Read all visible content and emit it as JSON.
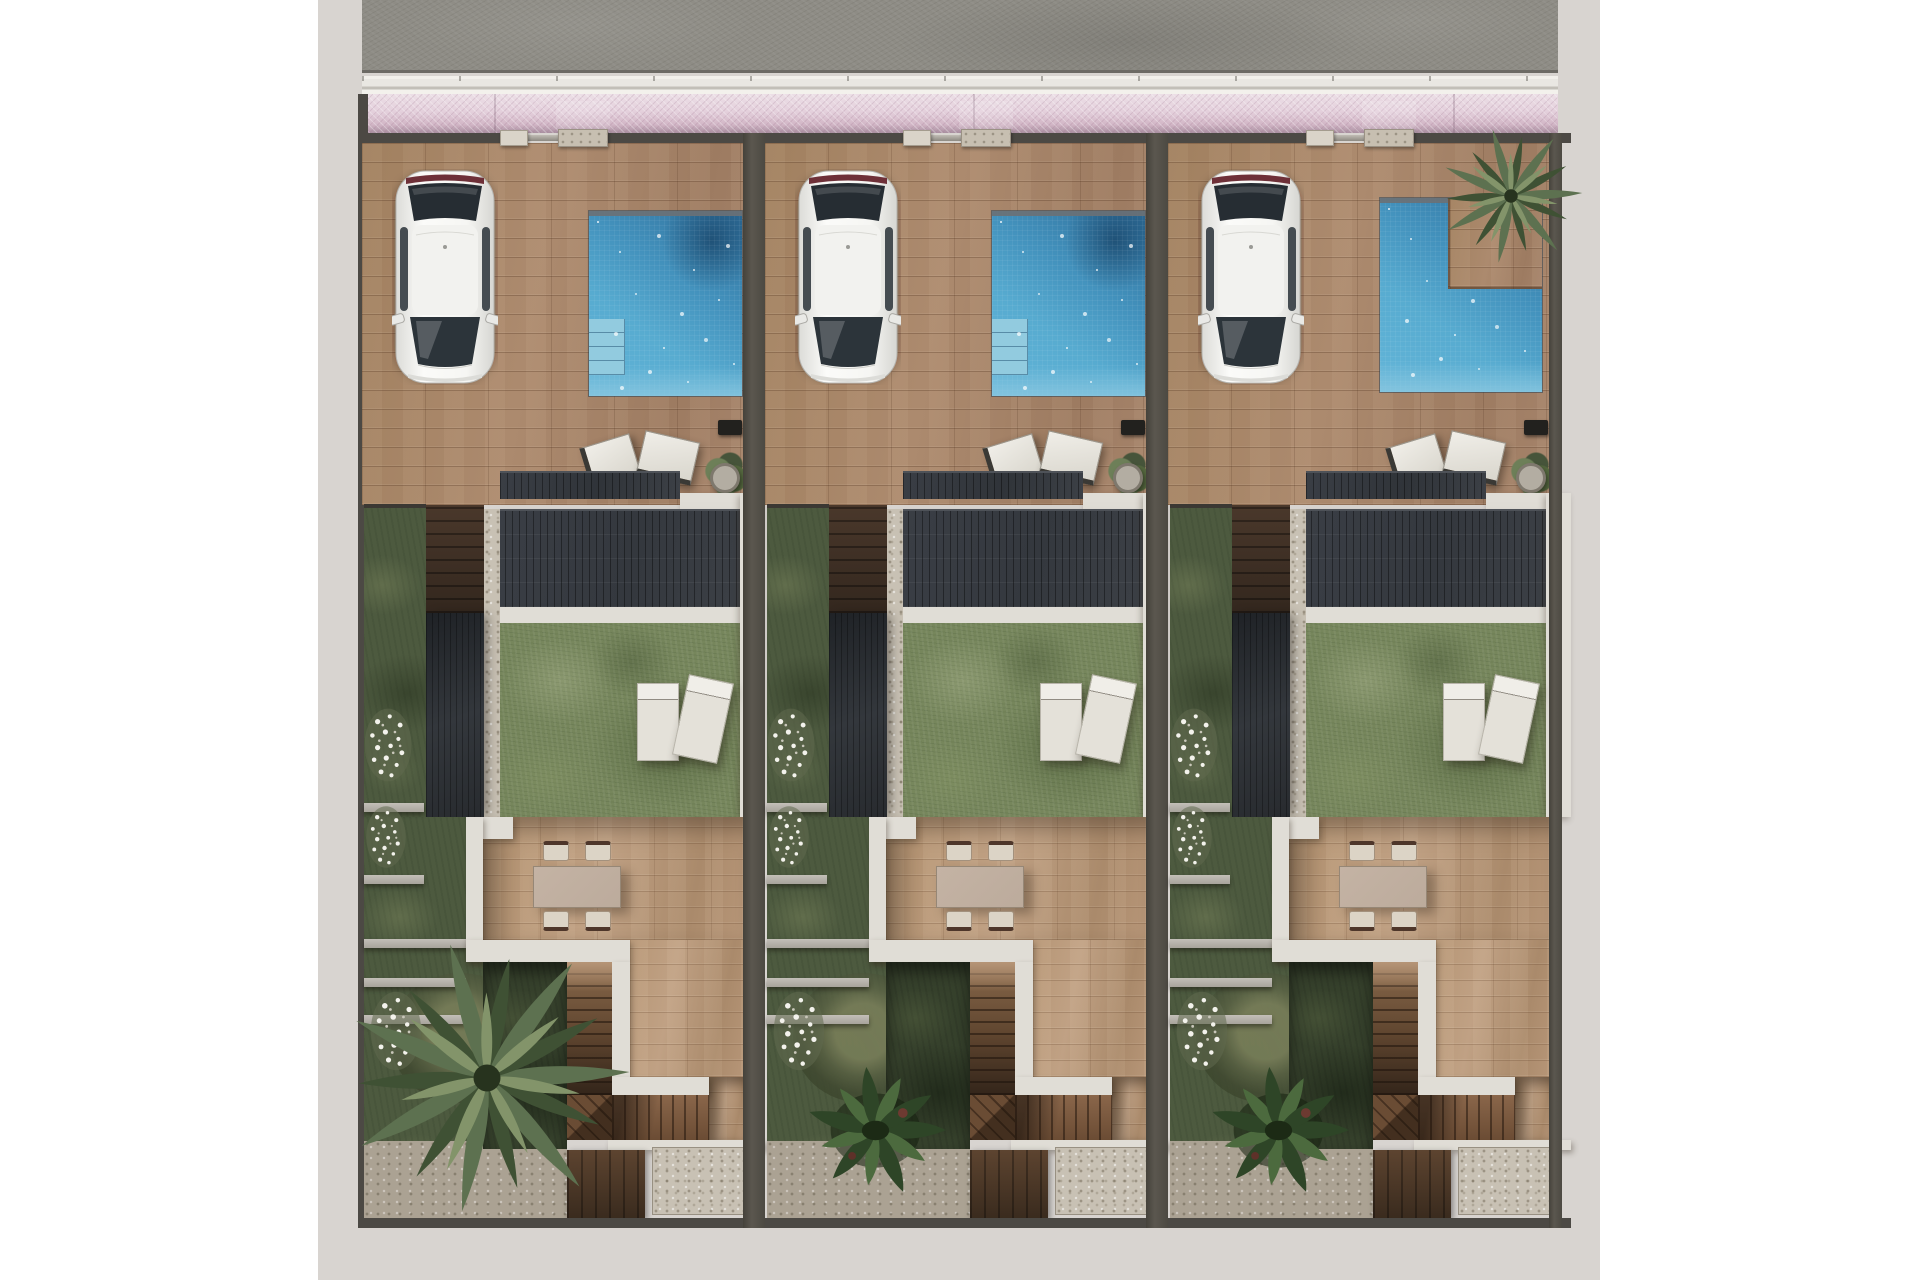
{
  "scene": {
    "label": "Aerial 3D site-plan render of three identical attached villas, each with street gate, paved driveway with parked white car, private pool, solar-panel roof, rear lawn with sun loungers, patio dining set, side stair garden and rear stairs down to a lower garden",
    "units_count": 3,
    "orientation": "street at top, rear gardens at bottom"
  },
  "palette": {
    "margin": "#ffffff",
    "apron": "#d8d4d0",
    "asphalt": "#8e8c85",
    "curb": "#e9e7e2",
    "sidewalk-hi": "#ecdfe6",
    "sidewalk-lo": "#a98fa0",
    "wall-dark": "#4c4944",
    "pier-light": "#dad4c9",
    "pier-mid": "#c7bfb1",
    "drive-base": "#a5836a",
    "patio-base": "#b69577",
    "pool-main": "#57abd0",
    "pool-deep": "#2e6d99",
    "pool-shallow": "#8cc8e0",
    "pool-step": "#92cbdf",
    "roof-base": "#34383e",
    "roof-seam": "#4e5258",
    "white-wall": "#e0ddd6",
    "lawn-base": "#76865c",
    "garden-base": "#4d5a3f",
    "garden-dark": "#36412c",
    "gravel": "#c8c1b4",
    "stair-wood": "#7b5a3e",
    "palm-dark": "#3f5134",
    "palm-mid": "#5d7150",
    "palm-light": "#83946a",
    "fern-dark": "#2e4527",
    "fern-mid": "#4c6a3e",
    "car-body": "#f4f4f1",
    "glass-dark": "#2c343a",
    "table-top": "#bcab9c",
    "chair-seat": "#dcd4c6",
    "frame-dark": "#4e362a",
    "flower-white": "#f3f2ec"
  },
  "units": [
    {
      "id": "villa-1",
      "pool_shape": "rectangular",
      "pool_steps": true,
      "top_flora": "none",
      "bottom_flora": "large-palm"
    },
    {
      "id": "villa-2",
      "pool_shape": "rectangular",
      "pool_steps": true,
      "top_flora": "none",
      "bottom_flora": "fern-cluster"
    },
    {
      "id": "villa-3",
      "pool_shape": "l-shaped",
      "pool_steps": false,
      "top_flora": "palm",
      "bottom_flora": "fern-cluster"
    }
  ],
  "features_per_unit": [
    "street-gate",
    "driveway",
    "parked-car",
    "swimming-pool",
    "deck-chairs",
    "potted-plant",
    "solar-roof",
    "rear-walkway",
    "lawn",
    "sun-loungers",
    "patio-terrace",
    "dining-set",
    "side-garden-steps",
    "stairs-to-lower-garden",
    "rear-garden"
  ]
}
